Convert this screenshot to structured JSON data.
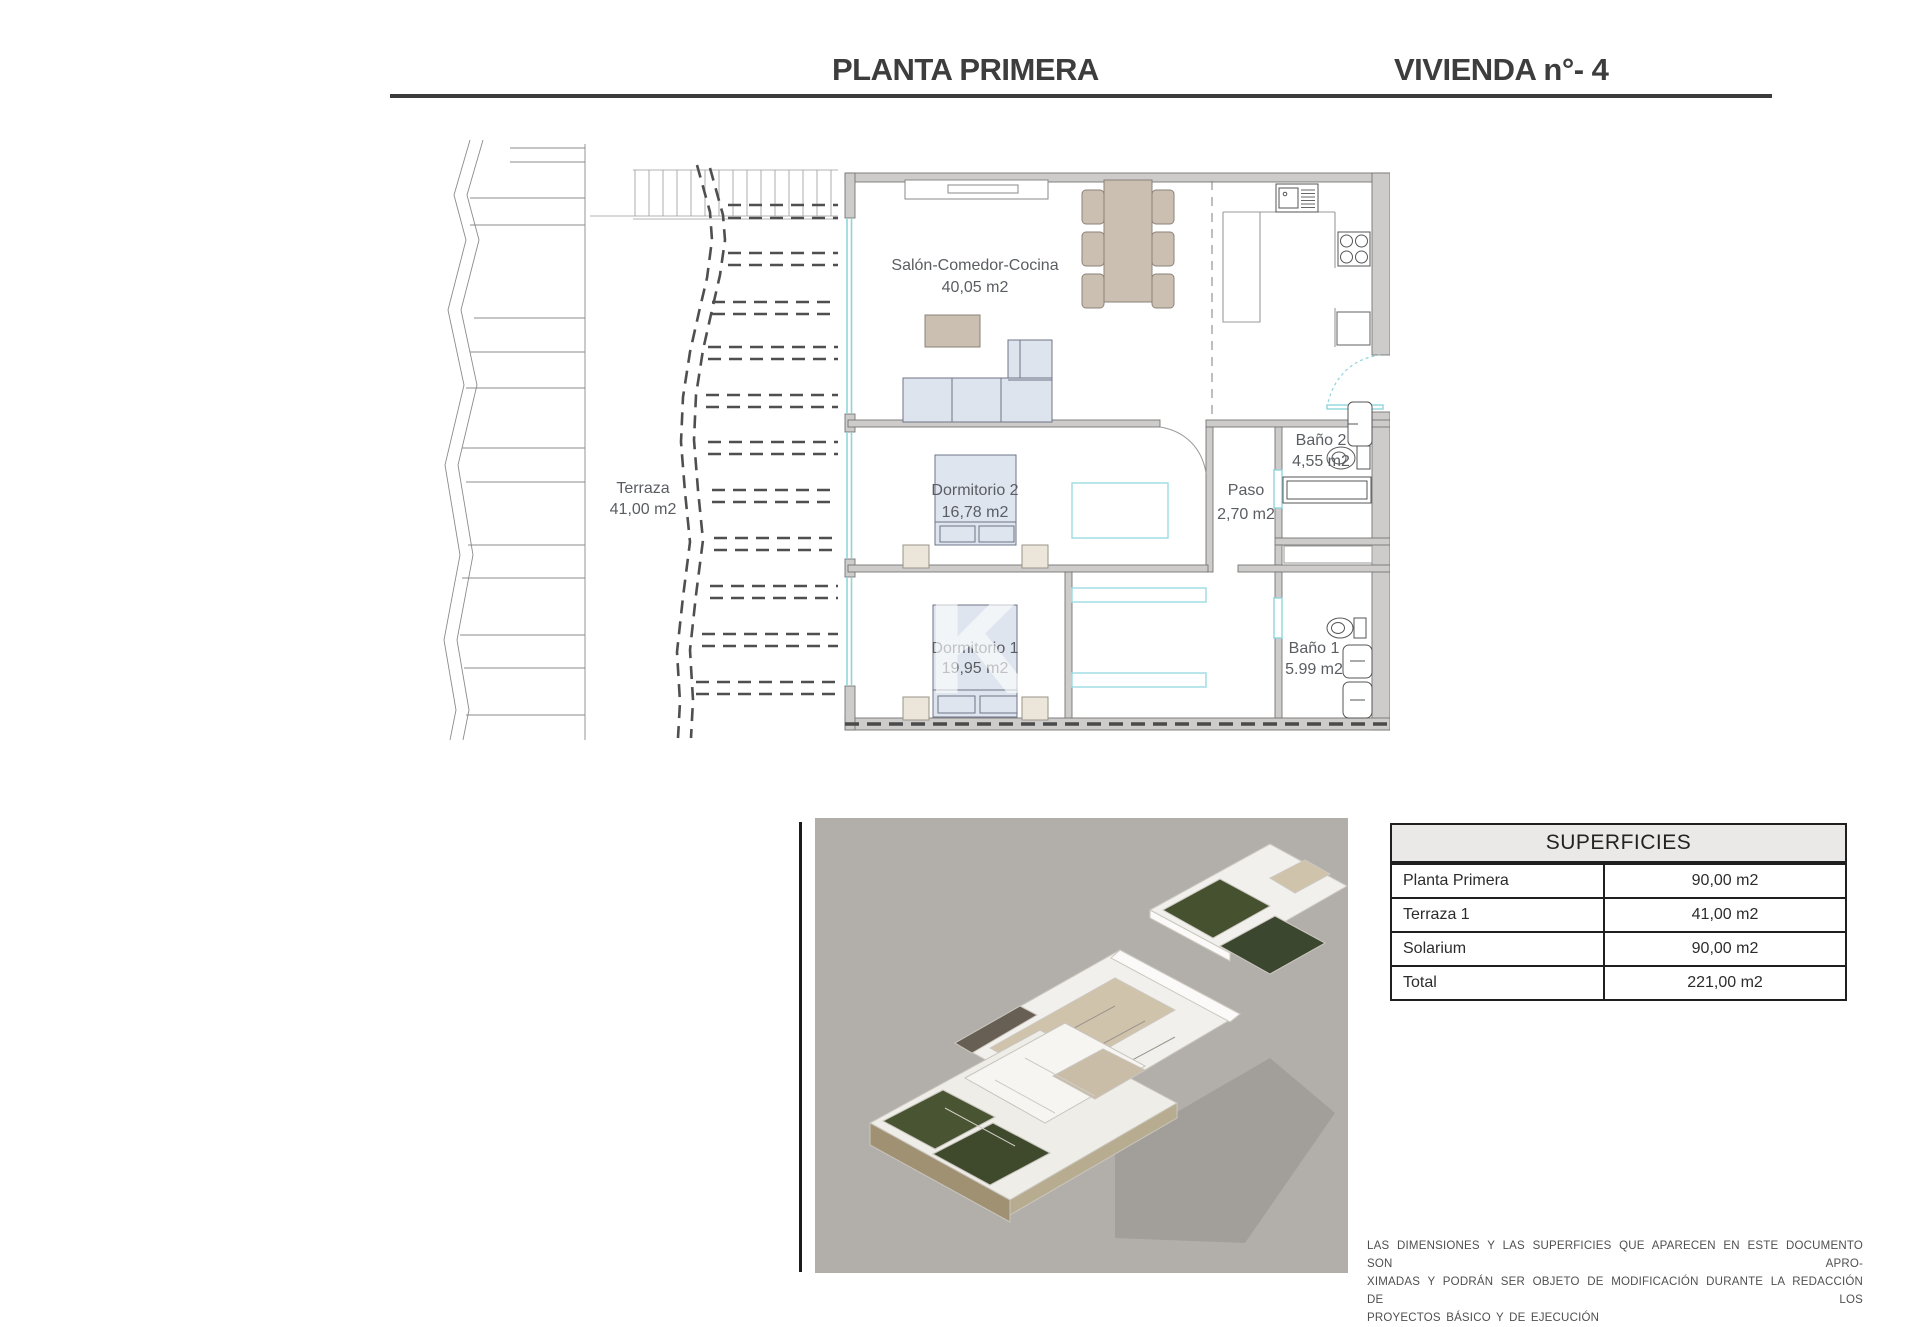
{
  "header": {
    "title_left": "PLANTA PRIMERA",
    "title_right": "VIVIENDA n°- 4"
  },
  "floorplan": {
    "rooms": {
      "salon": {
        "name": "Salón-Comedor-Cocina",
        "area": "40,05 m2"
      },
      "terraza": {
        "name": "Terraza",
        "area": "41,00 m2"
      },
      "dorm2": {
        "name": "Dormitorio 2",
        "area": "16,78 m2"
      },
      "dorm1": {
        "name": "Dormitorio 1",
        "area": "19,95 m2"
      },
      "paso": {
        "name": "Paso",
        "area": "2,70 m2"
      },
      "bano2": {
        "name": "Baño 2",
        "area": "4,55 m2"
      },
      "bano1": {
        "name": "Baño 1",
        "area": "5.99 m2"
      }
    },
    "watermark": "K"
  },
  "table": {
    "header": "SUPERFICIES",
    "rows": [
      {
        "label": "Planta Primera",
        "value": "90,00 m2"
      },
      {
        "label": "Terraza 1",
        "value": "41,00 m2"
      },
      {
        "label": "Solarium",
        "value": "90,00 m2"
      },
      {
        "label": "Total",
        "value": "221,00 m2"
      }
    ]
  },
  "disclaimer": {
    "line1": "LAS DIMENSIONES Y LAS SUPERFICIES QUE APARECEN EN ESTE DOCUMENTO SON APRO-",
    "line2": "XIMADAS Y PODRÁN SER OBJETO DE MODIFICACIÓN DURANTE LA REDACCIÓN DE LOS",
    "line3": "PROYECTOS BÁSICO Y DE EJECUCIÓN"
  },
  "colors": {
    "wall_gray": "#cecccb",
    "window_cyan": "#8fd5db",
    "furniture_tan": "#cbbfb1",
    "furniture_blue": "#dde4ee",
    "accent_dark": "#3b3b3b",
    "render_bg": "#b2afab"
  }
}
